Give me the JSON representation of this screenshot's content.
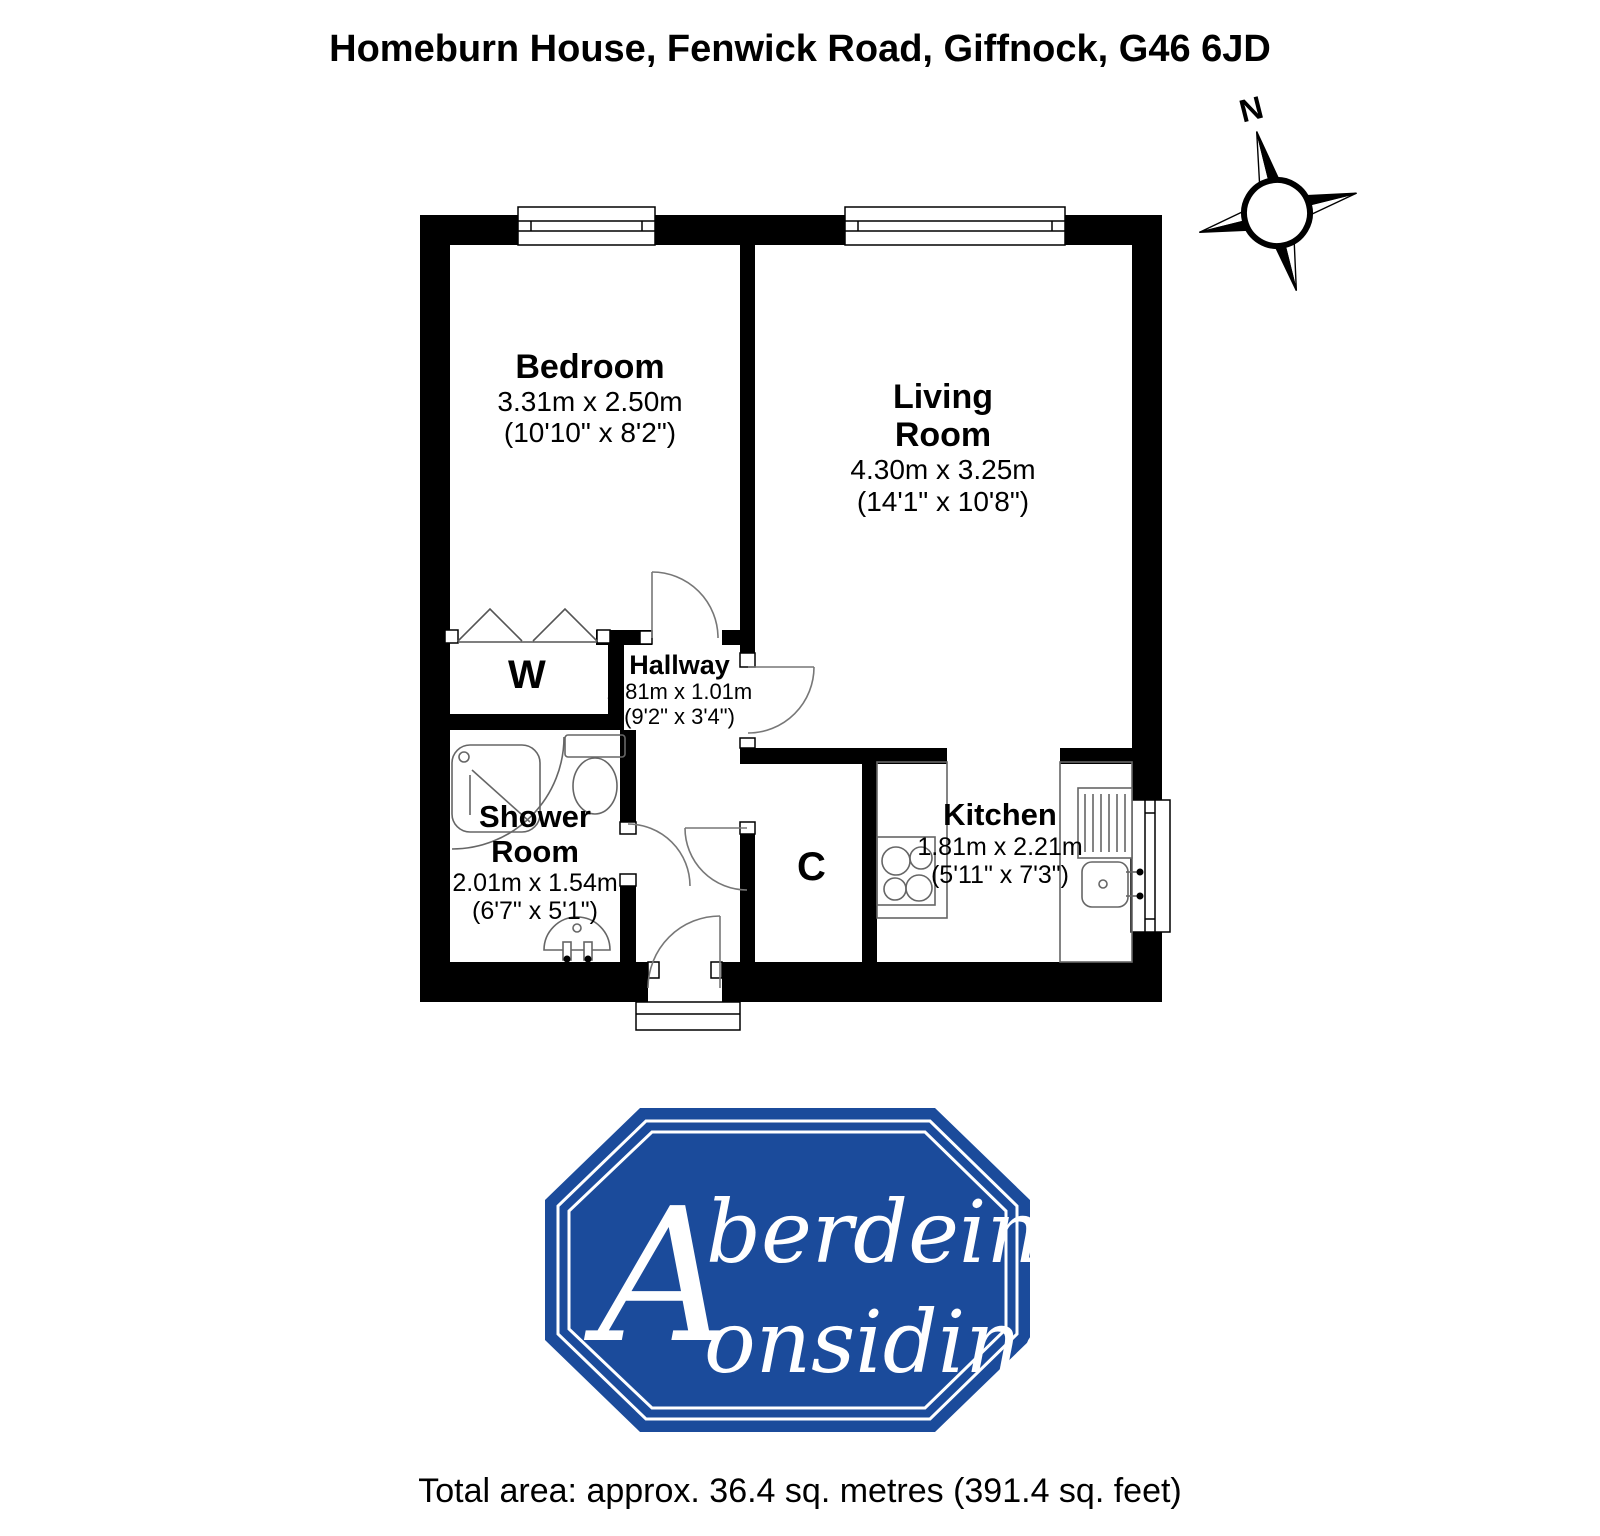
{
  "title": "Homeburn House, Fenwick Road, Giffnock, G46 6JD",
  "compass": {
    "north_label": "N"
  },
  "rooms": {
    "bedroom": {
      "name": "Bedroom",
      "metric": "3.31m x 2.50m",
      "imperial": "(10'10\" x 8'2\")"
    },
    "living_room": {
      "name": "Living Room",
      "metric": "4.30m x 3.25m",
      "imperial": "(14'1\" x 10'8\")"
    },
    "hallway": {
      "name": "Hallway",
      "metric": "2.81m x 1.01m",
      "imperial": "(9'2\" x 3'4\")"
    },
    "shower_room": {
      "name": "Shower Room",
      "metric": "2.01m x 1.54m",
      "imperial": "(6'7\" x 5'1\")"
    },
    "kitchen": {
      "name": "Kitchen",
      "metric": "1.81m x 2.21m",
      "imperial": "(5'11\" x 7'3\")"
    },
    "wardrobe": {
      "abbr": "W"
    },
    "cupboard": {
      "abbr": "C"
    }
  },
  "logo": {
    "monogram": "A",
    "line1": "berdein",
    "line2": "onsidine",
    "brand_color": "#1b4b9b"
  },
  "footer": {
    "total_area": "Total area: approx. 36.4 sq. metres (391.4 sq. feet)"
  }
}
